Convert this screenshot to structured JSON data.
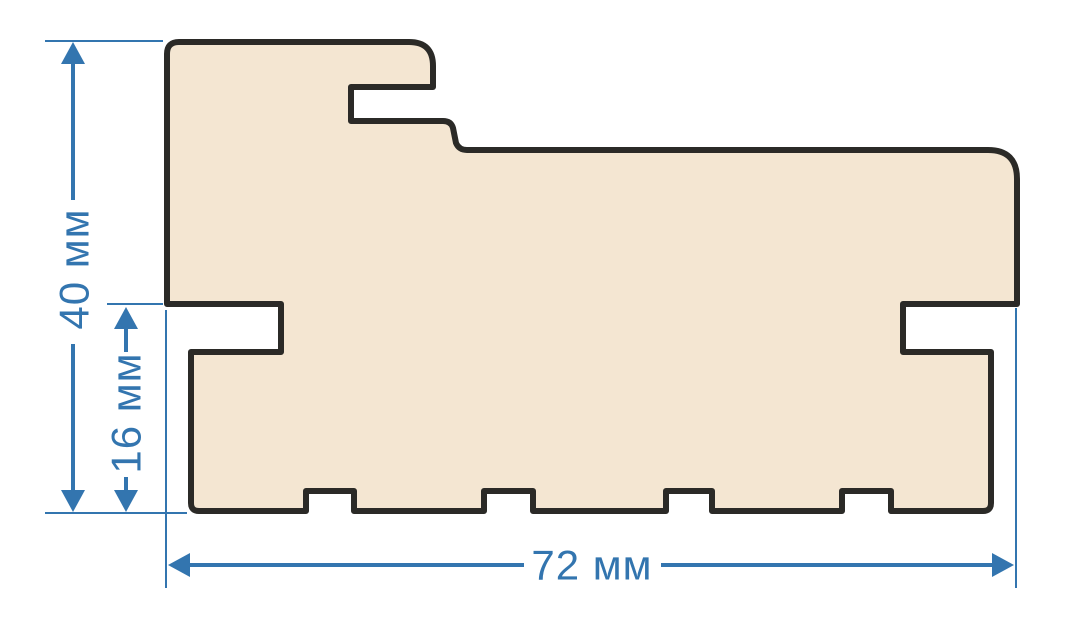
{
  "diagram": {
    "dimensions": {
      "height_label": "40 мм",
      "rebate_height_label": "16 мм",
      "width_label": "72 мм"
    },
    "colors": {
      "dimension_blue": "#3375af",
      "profile_fill": "#f4e6d2",
      "profile_outline": "#2b2a27",
      "background": "#ffffff"
    }
  }
}
